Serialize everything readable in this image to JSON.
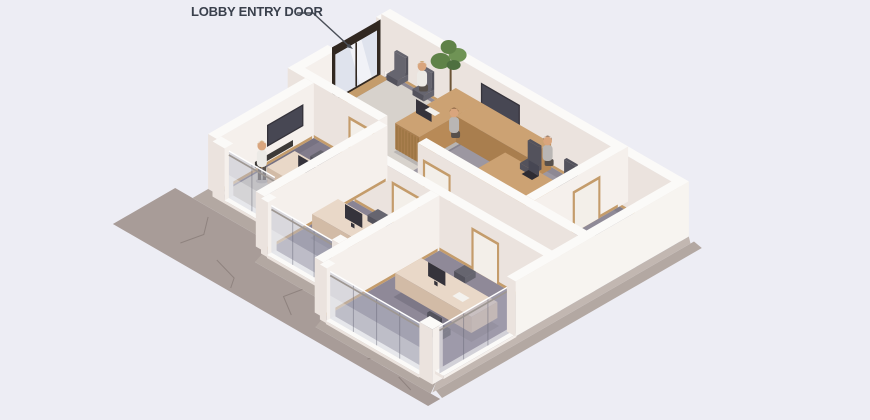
{
  "annotation": {
    "label": "LOBBY ENTRY DOOR"
  },
  "scene_elements": [
    "entry-door",
    "wayfinding-sign",
    "waiting-chairs",
    "potted-plant",
    "reception-desk",
    "reception-monitor",
    "wall-tv",
    "meeting-table",
    "laptop",
    "office-desk",
    "desk-monitor",
    "office-chair",
    "glass-partition",
    "interior-door",
    "carpet",
    "area-rug",
    "concrete-walkway",
    "person"
  ],
  "people_visible": 4,
  "colors": {
    "background": "#EDEDF4",
    "label_text": "#3A404C",
    "leader_line": "#4A4F58",
    "wall_top": "#FBFAF8",
    "wall_se": "#F5F0EC",
    "wall_sw": "#EBE3DE",
    "wall_bright": "#F7F4F0",
    "baseboard": "#C49C6B",
    "carpet_lobby": "#9C97A1",
    "carpet_far": "#8F8A97",
    "carpet_corridor": "#948E9B",
    "carpet_a": "#827C8C",
    "carpet_b": "#8A8494",
    "carpet_c": "#8F8998",
    "rug": "#D7D2CC",
    "mat": "#CCC5BF",
    "wood_top": "#CCA273",
    "wood_se": "#B88A57",
    "wood_sw": "#A97E4E",
    "slat_line": "#96713F",
    "desk_top": "#E9D8C8",
    "desk_se": "#DCC6B2",
    "desk_sw": "#D2BBA6",
    "door_frame": "#C49C6B",
    "door_leaf": "#F3EFE9",
    "entry_frame": "#312821",
    "entry_glass": "#DFE3ED",
    "tv_dark": "#35333B",
    "tv_screen": "#474753",
    "chair_dark": "#53525C",
    "chair_mid": "#66656F",
    "glass_tint": "rgba(186,190,205,0.48)",
    "glass_side": "rgba(172,170,186,0.52)",
    "glass_seam": "rgba(100,100,115,0.45)",
    "glass_rail": "#9E9792",
    "concrete": "#A89C98",
    "crack": "#8F837F",
    "plinth": "#B3A8A2",
    "foundation": "#C2B7B1",
    "plant_green": "#5F8248",
    "plant_light": "#6F9355",
    "plant_dark": "#4E7040",
    "pot": "#4A443E",
    "skin": "#D9A57D",
    "hair_brown": "#6E4A2F",
    "hair_blond": "#C49A5C",
    "shirt_light": "#ECEAE6",
    "shirt_grey": "#B9B6B4",
    "pants": "#57504B",
    "shadow": "rgba(47,42,60,0.18)",
    "ao": "rgba(60,54,74,0.14)",
    "sign_blue": "#5A79A8",
    "sign_grey": "#9AA0AB"
  }
}
